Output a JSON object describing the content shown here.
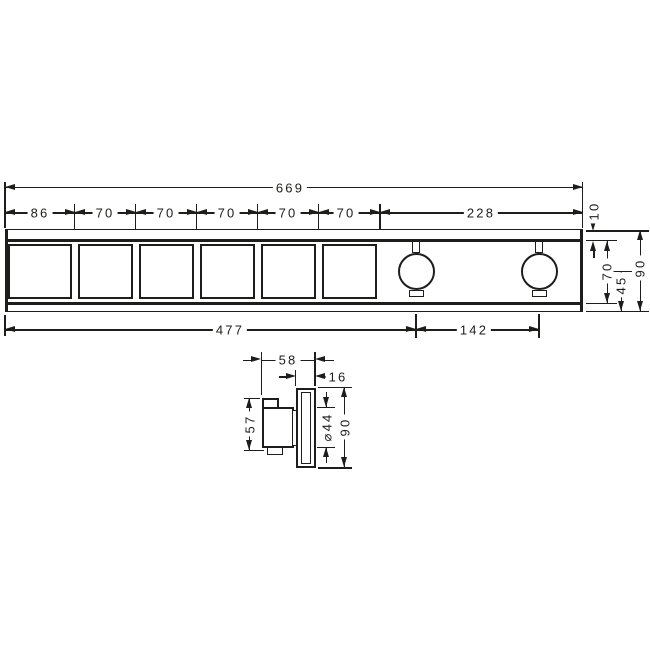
{
  "front_view": {
    "total_width": "669",
    "segment_widths": [
      "86",
      "70",
      "70",
      "70",
      "70",
      "70",
      "228"
    ],
    "bottom_dims": {
      "left_to_first_knob": "477",
      "knob_spacing": "142"
    },
    "right_dims": {
      "top_offset": "10",
      "field_height": "70",
      "center_to_bottom": "45",
      "total_height": "90"
    }
  },
  "side_view": {
    "total_depth": "58",
    "plate_depth": "16",
    "handle_height": "57",
    "handle_diameter": "⌀44",
    "plate_height": "90"
  },
  "colors": {
    "line": "#1d1d1b",
    "background": "#ffffff"
  }
}
